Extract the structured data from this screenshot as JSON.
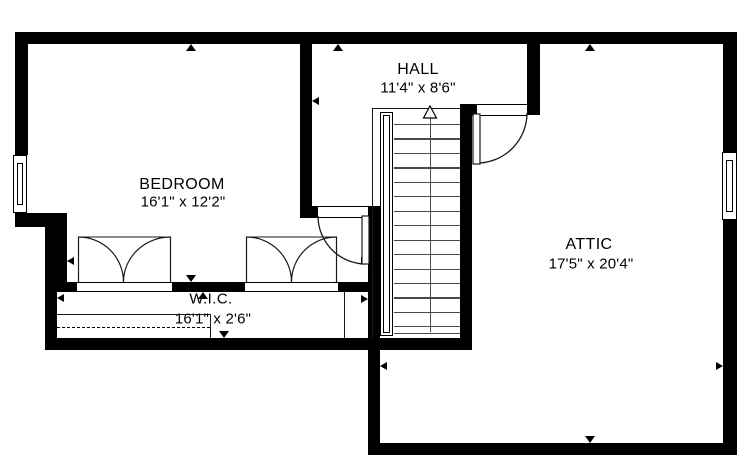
{
  "title": "Second floor plan",
  "colors": {
    "wall": "#000000",
    "background": "#ffffff",
    "stair_tread": "#4a4a4a",
    "door_arc": "#1a1a1a"
  },
  "rooms": {
    "bedroom": {
      "name": "BEDROOM",
      "dims": "16'1\" x 12'2\""
    },
    "hall": {
      "name": "HALL",
      "dims": "11'4\" x 8'6\""
    },
    "attic": {
      "name": "ATTIC",
      "dims": "17'5\" x 20'4\""
    },
    "wic": {
      "name": "W.I.C.",
      "dims": "16'1\" x 2'6\""
    }
  },
  "stairs": {
    "treads": 15,
    "direction": "up"
  }
}
